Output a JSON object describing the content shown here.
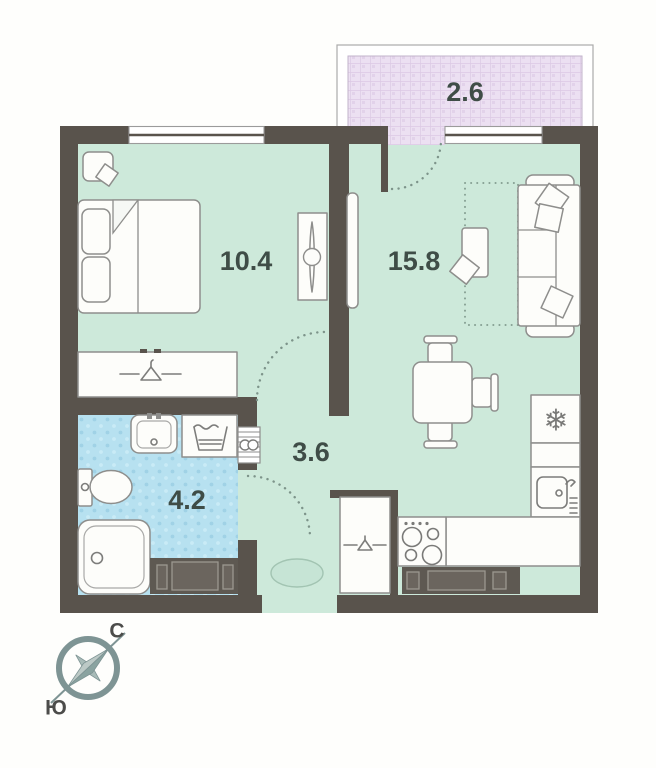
{
  "floor_plan": {
    "rooms": [
      {
        "id": "balcony",
        "area": "2.6"
      },
      {
        "id": "bedroom",
        "area": "10.4"
      },
      {
        "id": "living-kitchen",
        "area": "15.8"
      },
      {
        "id": "hallway",
        "area": "3.6"
      },
      {
        "id": "bathroom",
        "area": "4.2"
      }
    ],
    "compass": {
      "north": "С",
      "south": "Ю"
    },
    "glyphs": {
      "freezer_snowflake": "❄"
    },
    "colors": {
      "wall": "#59534c",
      "room_floor": "#cde9da",
      "bathroom_floor": "#b7e1f0",
      "balcony_floor": "#ece0f2",
      "furniture_outline": "#8e8e8c",
      "dark_furniture": "#5e5952",
      "label_text": "#3f4d47",
      "compass": "#7e9494"
    }
  }
}
